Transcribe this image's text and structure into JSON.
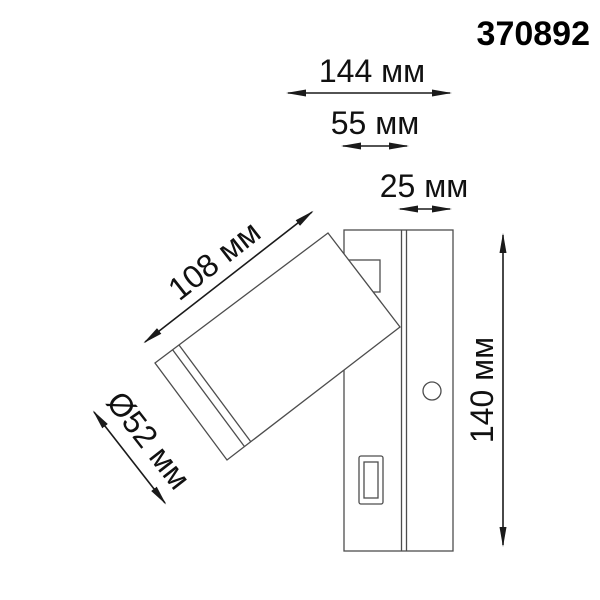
{
  "header": {
    "product_code": "370892"
  },
  "diagram": {
    "type": "technical-dimension-drawing",
    "units": "мм",
    "labels": {
      "total_depth": "144 мм",
      "base_depth": "55 мм",
      "plate_thickness": "25 мм",
      "head_length": "108 мм",
      "head_diameter": "Ø52 мм",
      "height": "140 мм"
    },
    "colors": {
      "background": "#ffffff",
      "fixture_line": "#4d4d4d",
      "dimension_line": "#1a1a1a",
      "text": "#111111"
    }
  }
}
